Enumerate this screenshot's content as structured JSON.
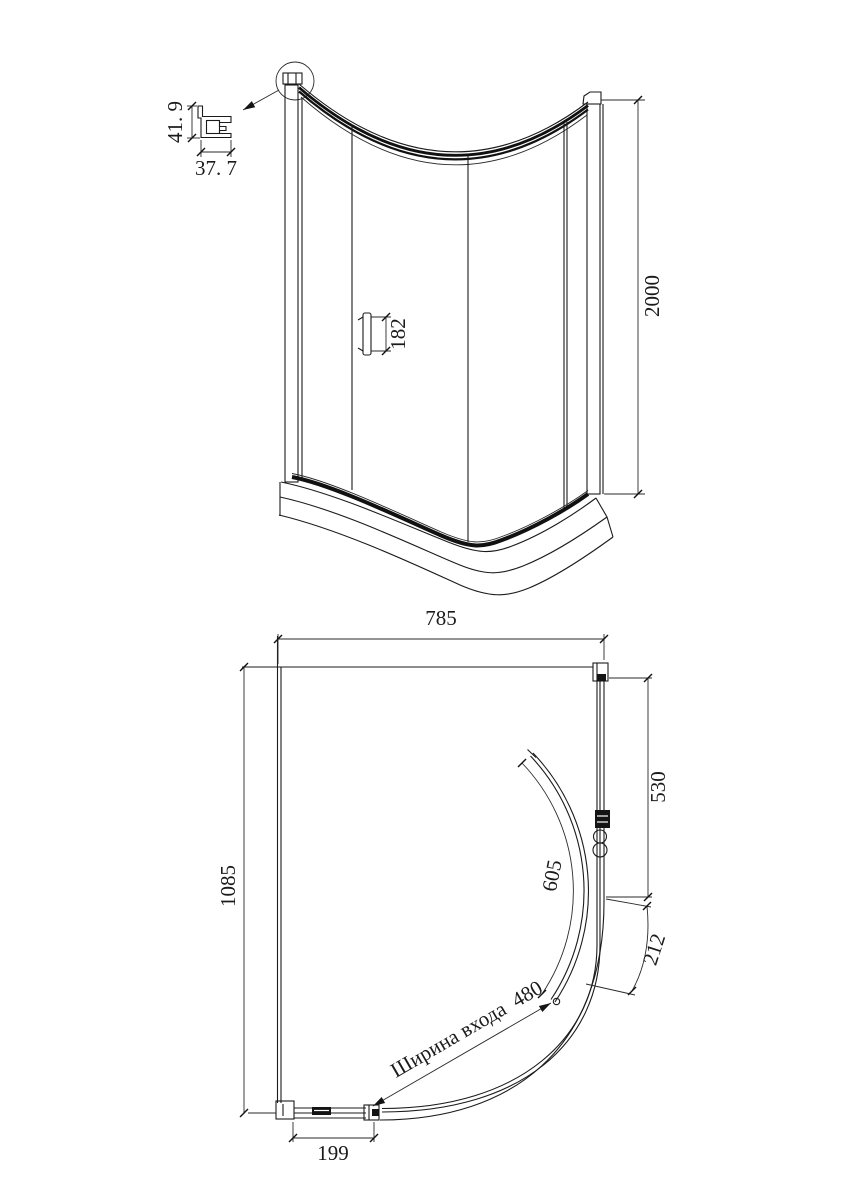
{
  "drawing": {
    "kind": "shower enclosure technical drawing",
    "background": "#ffffff",
    "line_color": "#1b1b1b"
  },
  "front_view": {
    "name": "front-elevation",
    "profile_detail": {
      "height": "41. 9",
      "width": "37. 7"
    },
    "handle_length": "182",
    "total_height": "2000"
  },
  "plan_view": {
    "name": "top-plan",
    "total_width": "785",
    "total_depth": "1085",
    "side_section": "530",
    "door_arc_length": "605",
    "corner_arc_length": "212",
    "entrance_width_label": "Ширина входа  480",
    "wall_panel_width": "199"
  }
}
